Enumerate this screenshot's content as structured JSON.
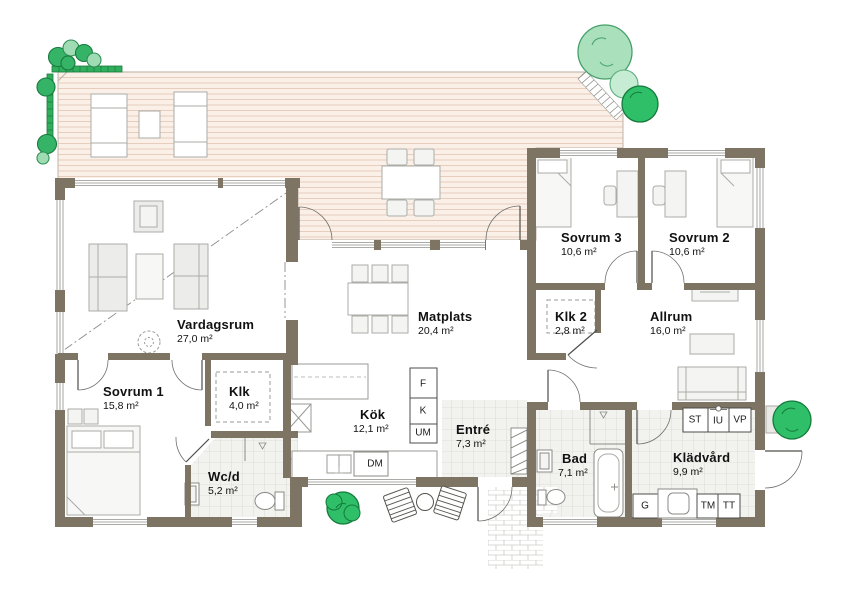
{
  "plan": {
    "rooms": [
      {
        "name": "Vardagsrum",
        "area": "27,0 m²"
      },
      {
        "name": "Sovrum 1",
        "area": "15,8 m²"
      },
      {
        "name": "Klk",
        "area": "4,0 m²"
      },
      {
        "name": "Wc/d",
        "area": "5,2 m²"
      },
      {
        "name": "Kök",
        "area": "12,1 m²"
      },
      {
        "name": "Matplats",
        "area": "20,4 m²"
      },
      {
        "name": "Entré",
        "area": "7,3 m²"
      },
      {
        "name": "Bad",
        "area": "7,1 m²"
      },
      {
        "name": "Klädvård",
        "area": "9,9 m²"
      },
      {
        "name": "Sovrum 3",
        "area": "10,6 m²"
      },
      {
        "name": "Sovrum 2",
        "area": "10,6 m²"
      },
      {
        "name": "Klk 2",
        "area": "2,8 m²"
      },
      {
        "name": "Allrum",
        "area": "16,0 m²"
      }
    ],
    "appliance_labels": {
      "freezer": "F",
      "fridge": "K",
      "oven_micro": "UM",
      "dishwasher": "DM",
      "cleaning_cabinet": "ST",
      "sink_unit": "IU",
      "heat_pump": "VP",
      "wardrobe": "G",
      "washer": "TM",
      "dryer": "TT"
    },
    "colors": {
      "wall": "#7d7464",
      "deck": "#faf0e8",
      "deck_line": "#e7cdbb",
      "tile": "#f2f2ef",
      "tile_line": "#d6d6d2",
      "furniture": "#ececea",
      "tree_green": "#2fbf68",
      "tree_light": "#abe0bd",
      "hedge": "#2fae5c"
    }
  }
}
